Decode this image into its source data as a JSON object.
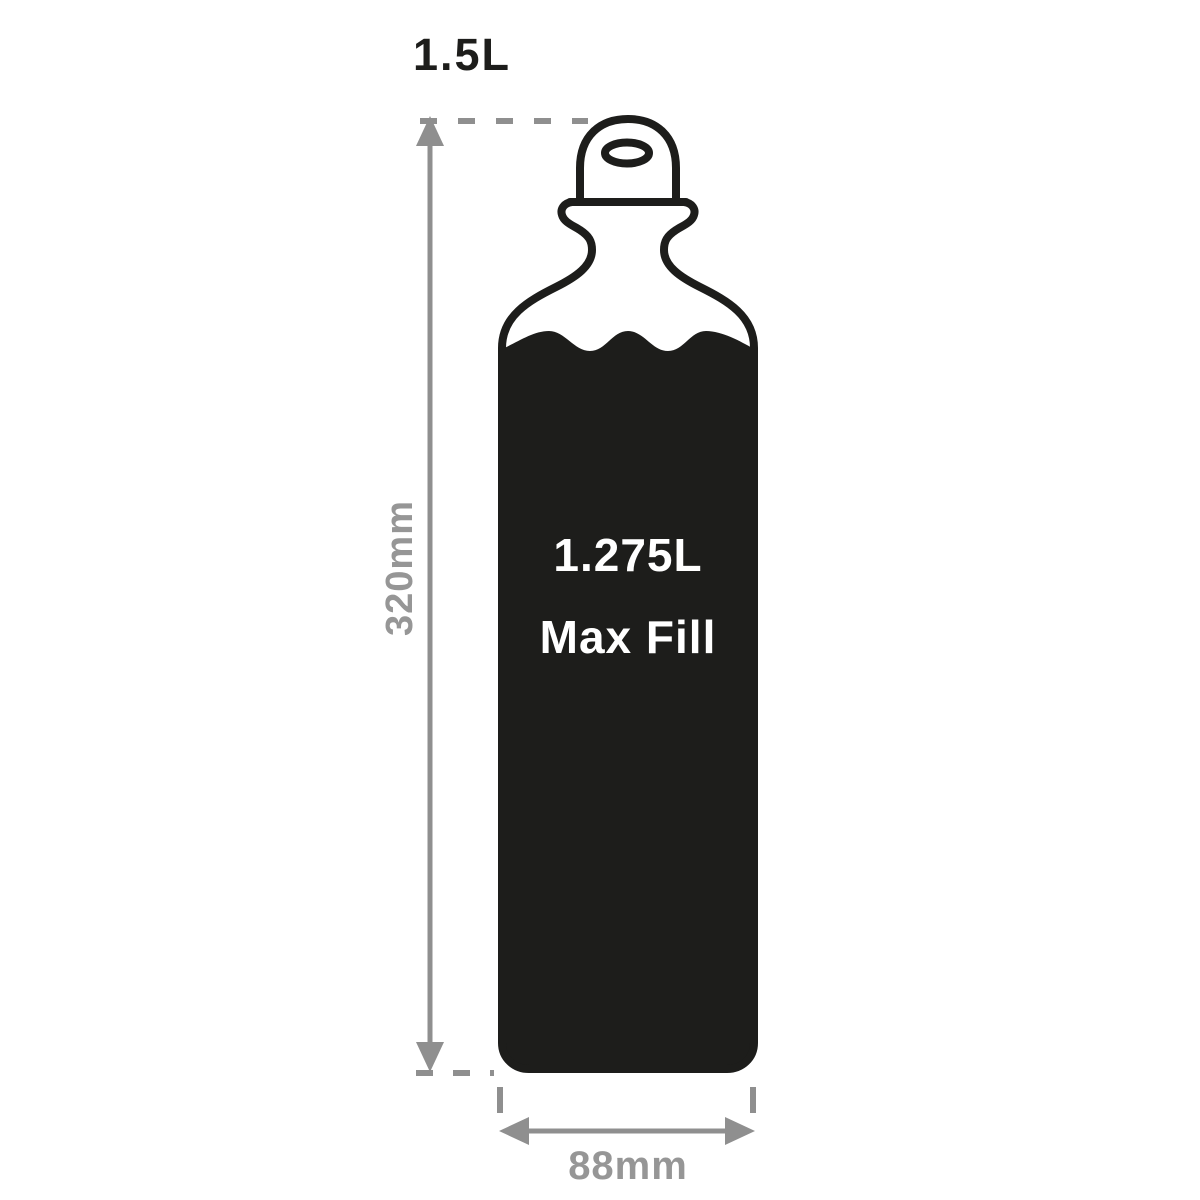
{
  "diagram": {
    "title_label": "1.5L",
    "height_label": "320mm",
    "width_label": "88mm",
    "max_fill_line1": "1.275L",
    "max_fill_line2": "Max Fill",
    "colors": {
      "outline": "#1d1d1b",
      "fill": "#1d1d1b",
      "dimension": "#8f8f8f",
      "dimension_text": "#969696",
      "fill_text": "#ffffff",
      "background": "#ffffff"
    }
  }
}
